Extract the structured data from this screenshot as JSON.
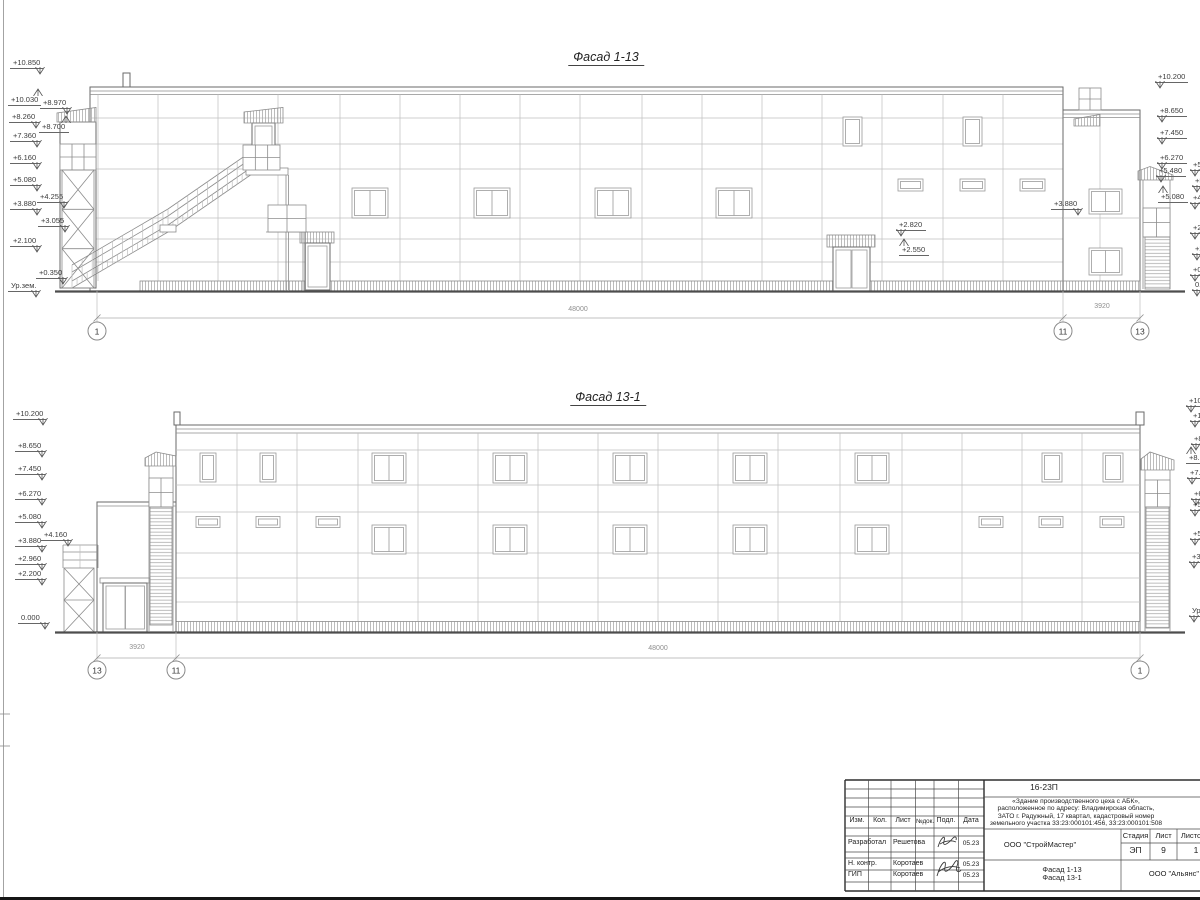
{
  "drawing": {
    "facade_top": {
      "title": "Фасад 1-13",
      "marks": [
        {
          "t": "+10.850",
          "x": 10,
          "y": 58,
          "d": "dn",
          "s": "r"
        },
        {
          "t": "+10.030",
          "x": 8,
          "y": 95,
          "d": "up",
          "s": "r"
        },
        {
          "t": "+8.970",
          "x": 40,
          "y": 98,
          "d": "dn",
          "s": "r"
        },
        {
          "t": "+8.260",
          "x": 9,
          "y": 112,
          "d": "dn",
          "s": "r"
        },
        {
          "t": "+8.700",
          "x": 39,
          "y": 122,
          "d": "up",
          "s": "r"
        },
        {
          "t": "+7.360",
          "x": 10,
          "y": 131,
          "d": "dn",
          "s": "r"
        },
        {
          "t": "+6.160",
          "x": 10,
          "y": 153,
          "d": "dn",
          "s": "r"
        },
        {
          "t": "+5.080",
          "x": 10,
          "y": 175,
          "d": "dn",
          "s": "r"
        },
        {
          "t": "+4.255",
          "x": 37,
          "y": 192,
          "d": "dn",
          "s": "r"
        },
        {
          "t": "+3.880",
          "x": 10,
          "y": 199,
          "d": "dn",
          "s": "r"
        },
        {
          "t": "+3.055",
          "x": 38,
          "y": 216,
          "d": "dn",
          "s": "r"
        },
        {
          "t": "+2.100",
          "x": 10,
          "y": 236,
          "d": "dn",
          "s": "r"
        },
        {
          "t": "+0.350",
          "x": 36,
          "y": 268,
          "d": "dn",
          "s": "r"
        },
        {
          "t": "Ур.зем.",
          "x": 8,
          "y": 281,
          "d": "dn",
          "s": "r"
        },
        {
          "t": "+10.200",
          "x": 1155,
          "y": 72,
          "d": "dn",
          "s": "l"
        },
        {
          "t": "+8.650",
          "x": 1157,
          "y": 106,
          "d": "dn",
          "s": "l"
        },
        {
          "t": "+7.450",
          "x": 1157,
          "y": 128,
          "d": "dn",
          "s": "l"
        },
        {
          "t": "+6.270",
          "x": 1157,
          "y": 153,
          "d": "dn",
          "s": "l"
        },
        {
          "t": "+5.480",
          "x": 1156,
          "y": 166,
          "d": "dn",
          "s": "l"
        },
        {
          "t": "+5.080",
          "x": 1158,
          "y": 192,
          "d": "up",
          "s": "l"
        },
        {
          "t": "+3.880",
          "x": 1051,
          "y": 199,
          "d": "dn",
          "s": "r"
        },
        {
          "t": "+2.820",
          "x": 896,
          "y": 220,
          "d": "dn",
          "s": "l"
        },
        {
          "t": "+2.550",
          "x": 899,
          "y": 245,
          "d": "up",
          "s": "l"
        },
        {
          "t": "+5.4",
          "x": 1190,
          "y": 160,
          "d": "dn",
          "s": "l"
        },
        {
          "t": "+5.0",
          "x": 1192,
          "y": 176,
          "d": "dn",
          "s": "l"
        },
        {
          "t": "+4.2",
          "x": 1190,
          "y": 193,
          "d": "dn",
          "s": "l"
        },
        {
          "t": "+2.5",
          "x": 1190,
          "y": 223,
          "d": "dn",
          "s": "l"
        },
        {
          "t": "+2.1",
          "x": 1192,
          "y": 244,
          "d": "dn",
          "s": "l"
        },
        {
          "t": "+0.3",
          "x": 1190,
          "y": 265,
          "d": "dn",
          "s": "l"
        },
        {
          "t": "0.00",
          "x": 1192,
          "y": 280,
          "d": "dn",
          "s": "l"
        }
      ],
      "dims": [
        {
          "t": "48000",
          "x": 578,
          "y": 306
        },
        {
          "t": "3920",
          "x": 1102,
          "y": 303
        }
      ],
      "axes": [
        {
          "t": "1",
          "x": 97
        },
        {
          "t": "11",
          "x": 1063
        },
        {
          "t": "13",
          "x": 1140
        }
      ],
      "axes_y": 331
    },
    "facade_bottom": {
      "title": "Фасад 13-1",
      "marks": [
        {
          "t": "+10.200",
          "x": 13,
          "y": 409,
          "d": "dn",
          "s": "r"
        },
        {
          "t": "+8.650",
          "x": 15,
          "y": 441,
          "d": "dn",
          "s": "r"
        },
        {
          "t": "+7.450",
          "x": 15,
          "y": 464,
          "d": "dn",
          "s": "r"
        },
        {
          "t": "+6.270",
          "x": 15,
          "y": 489,
          "d": "dn",
          "s": "r"
        },
        {
          "t": "+5.080",
          "x": 15,
          "y": 512,
          "d": "dn",
          "s": "r"
        },
        {
          "t": "+4.160",
          "x": 41,
          "y": 530,
          "d": "dn",
          "s": "r"
        },
        {
          "t": "+3.880",
          "x": 15,
          "y": 536,
          "d": "dn",
          "s": "r"
        },
        {
          "t": "+2.960",
          "x": 15,
          "y": 554,
          "d": "dn",
          "s": "r"
        },
        {
          "t": "+2.200",
          "x": 15,
          "y": 569,
          "d": "dn",
          "s": "r"
        },
        {
          "t": "0.000",
          "x": 18,
          "y": 613,
          "d": "dn",
          "s": "r"
        },
        {
          "t": "+10.8",
          "x": 1186,
          "y": 396,
          "d": "dn",
          "s": "l"
        },
        {
          "t": "+10.0",
          "x": 1190,
          "y": 411,
          "d": "dn",
          "s": "l"
        },
        {
          "t": "+8.9",
          "x": 1191,
          "y": 434,
          "d": "dn",
          "s": "l"
        },
        {
          "t": "+8.7",
          "x": 1186,
          "y": 453,
          "d": "up",
          "s": "l"
        },
        {
          "t": "+7.3",
          "x": 1187,
          "y": 468,
          "d": "dn",
          "s": "l"
        },
        {
          "t": "+6.1",
          "x": 1191,
          "y": 489,
          "d": "dn",
          "s": "l"
        },
        {
          "t": "+5.4",
          "x": 1190,
          "y": 500,
          "d": "dn",
          "s": "l"
        },
        {
          "t": "+5.0",
          "x": 1190,
          "y": 529,
          "d": "dn",
          "s": "l"
        },
        {
          "t": "+3.8",
          "x": 1189,
          "y": 552,
          "d": "dn",
          "s": "l"
        },
        {
          "t": "Ур.зем.",
          "x": 1189,
          "y": 606,
          "d": "dn",
          "s": "l"
        }
      ],
      "dims": [
        {
          "t": "3920",
          "x": 137,
          "y": 644
        },
        {
          "t": "48000",
          "x": 658,
          "y": 645
        }
      ],
      "axes": [
        {
          "t": "13",
          "x": 97
        },
        {
          "t": "11",
          "x": 176
        },
        {
          "t": "1",
          "x": 1140
        }
      ],
      "axes_y": 670
    }
  },
  "titleblock": {
    "doc_number": "16-23П",
    "description": [
      "«Здание производственного цеха с АБК»,",
      "расположенное по адресу: Владимирская область,",
      "ЗАТО г. Радужный, 17 квартал, кадастровый номер",
      "земельного участка 33:23:000101:456, 33:23:000101:508"
    ],
    "header_cols": [
      "Изм.",
      "Кол.",
      "Лист",
      "№док.",
      "Подл.",
      "Дата"
    ],
    "rows": [
      {
        "role": "Разработал",
        "name": "Решетова",
        "date": "05.23"
      },
      {
        "role": "Н. контр.",
        "name": "Коротаев",
        "date": "05.23"
      },
      {
        "role": "ГИП",
        "name": "Коротаев",
        "date": "05.23"
      }
    ],
    "company": "ООО \"СтройМастер\"",
    "stage_label": "Стадия",
    "sheet_label": "Лист",
    "sheets_label": "Листов",
    "stage": "ЭП",
    "sheet": "9",
    "sheets": "1",
    "content_lines": [
      "Фасад 1-13",
      "Фасад 13-1"
    ],
    "firm": "ООО \"Альянс\""
  }
}
